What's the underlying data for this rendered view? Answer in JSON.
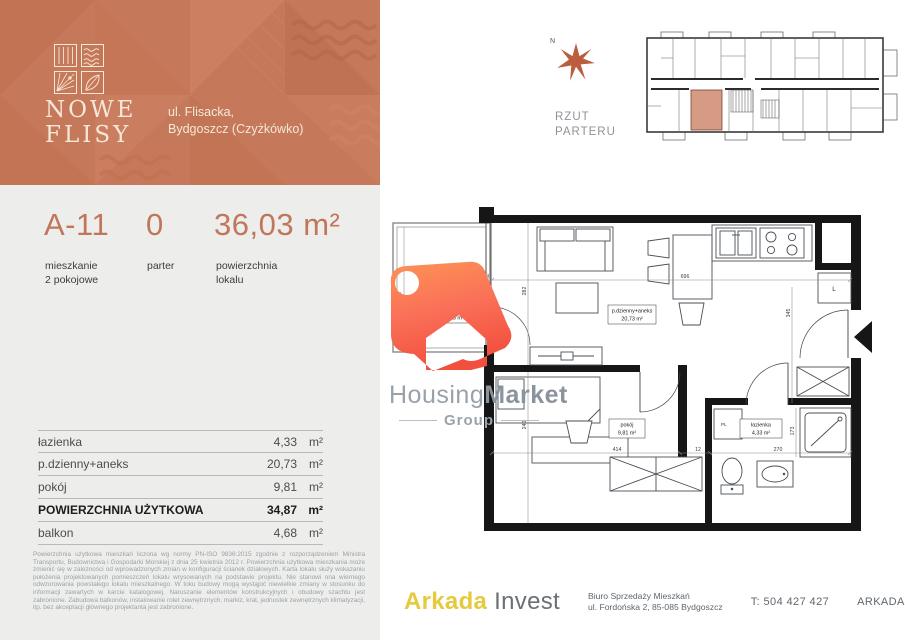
{
  "header": {
    "title_line1": "NOWE",
    "title_line2": "FLISY",
    "address_line1": "ul. Flisacka,",
    "address_line2": "Bydgoszcz (Czyżkówko)",
    "brand_color": "#c6795a"
  },
  "unit": {
    "code": "A-11",
    "code_sub1": "mieszkanie",
    "code_sub2": "2 pokojowe",
    "floor": "0",
    "floor_sub": "parter",
    "area": "36,03 m²",
    "area_sub1": "powierzchnia",
    "area_sub2": "lokalu"
  },
  "rooms_table": {
    "rows": [
      {
        "label": "łazienka",
        "value": "4,33",
        "unit": "m²"
      },
      {
        "label": "p.dzienny+aneks",
        "value": "20,73",
        "unit": "m²"
      },
      {
        "label": "pokój",
        "value": "9,81",
        "unit": "m²"
      },
      {
        "label": "POWIERZCHNIA UŻYTKOWA",
        "value": "34,87",
        "unit": "m²"
      },
      {
        "label": "balkon",
        "value": "4,68",
        "unit": "m²"
      }
    ]
  },
  "disclaimer": "Powierzchnia użytkowa mieszkań liczona wg normy PN-ISO 9836:2015 zgodnie z rozporządzeniem Ministra Transportu, Budownictwa i Gospodarki Morskiej z dnia 25 kwietnia 2012 r. Powierzchnia użytkowa mieszkania może zmienić się w zależności od wprowadzonych zmian w konfiguracji ścianek działowych. Karta lokalu służy wskazaniu położenia projektowanych pomieszczeń lokalu wrysowanych na podstawie projektu. Nie stanowi ona wiernego odwzorowania powstałego lokalu mieszkalnego. W toku budowy mogą wystąpić niewielkie zmiany w stosunku do informacji zawartych w karcie katalogowej. Naruszanie elementów konstrukcyjnych i obudowy szachtu jest zabronione. Zabudowa balkonów, instalowanie rolet zewnętrznych, markiz, krat, jednostek zewnętrznych klimatyzacji, itp. bez akceptacji głównego projektanta jest zabronione.",
  "site_plan": {
    "label_line1": "RZUT",
    "label_line2": "PARTERU",
    "north": "N",
    "highlight_color": "#d69b84"
  },
  "floor_plan": {
    "labels": {
      "living_name": "p.dzienny+aneks",
      "living_area": "20,73 m²",
      "room_name": "pokój",
      "room_area": "9,81 m²",
      "bath_name": "łazienka",
      "bath_area": "4,33 m²",
      "balcony_area": "4,68 m²",
      "fridge": "L",
      "washer": "PL"
    },
    "dims": {
      "living_w": "696",
      "living_h": "282",
      "hall_h": "345",
      "bed_h": "240",
      "bed_w": "414",
      "gap": "12",
      "bath_w": "270",
      "shower_h": "173",
      "balcony_door": "40",
      "balcony_h": "75"
    }
  },
  "watermark": {
    "name_part1": "Housing",
    "name_part2": "Market",
    "subtitle": "Group"
  },
  "footer": {
    "brand_part1": "Arkada",
    "brand_part2": "Invest",
    "office_line1": "Biuro Sprzedaży Mieszkań",
    "office_line2": "ul. Fordońska 2, 85-085 Bydgoszcz",
    "phone": "T: 504 427 427",
    "website": "ARKADA-INVEST.PL"
  }
}
